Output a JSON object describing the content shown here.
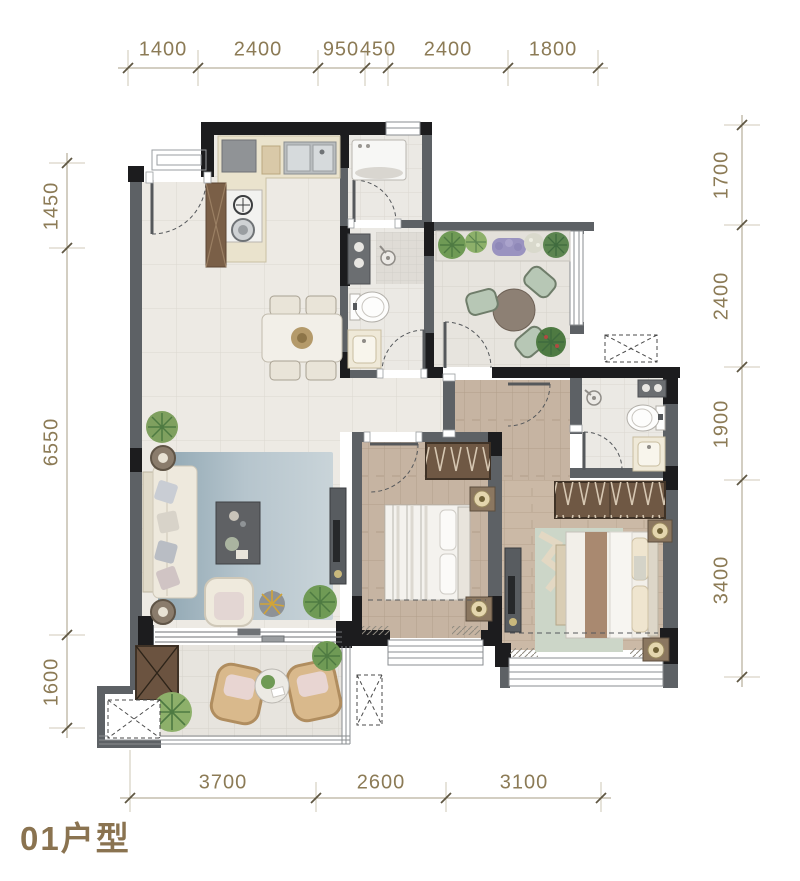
{
  "title": "01户型",
  "dimensions": {
    "top": [
      "1400",
      "2400",
      "950",
      "450",
      "2400",
      "1800"
    ],
    "bottom": [
      "3700",
      "2600",
      "3100"
    ],
    "left": [
      "1450",
      "6550",
      "1600"
    ],
    "right": [
      "1700",
      "2400",
      "1900",
      "3400"
    ]
  },
  "colors": {
    "dimension_text": "#8c7b56",
    "title_text": "#8a7350",
    "wall_dark": "#1c1c1e",
    "wall_gray": "#5d6165",
    "wood_floor": "#c6b4a2",
    "tile_floor": "#edeae4",
    "rug_blue": "#a3b7c1",
    "cabinet_brown": "#6f5844",
    "plant_green": "#6f9a55"
  }
}
